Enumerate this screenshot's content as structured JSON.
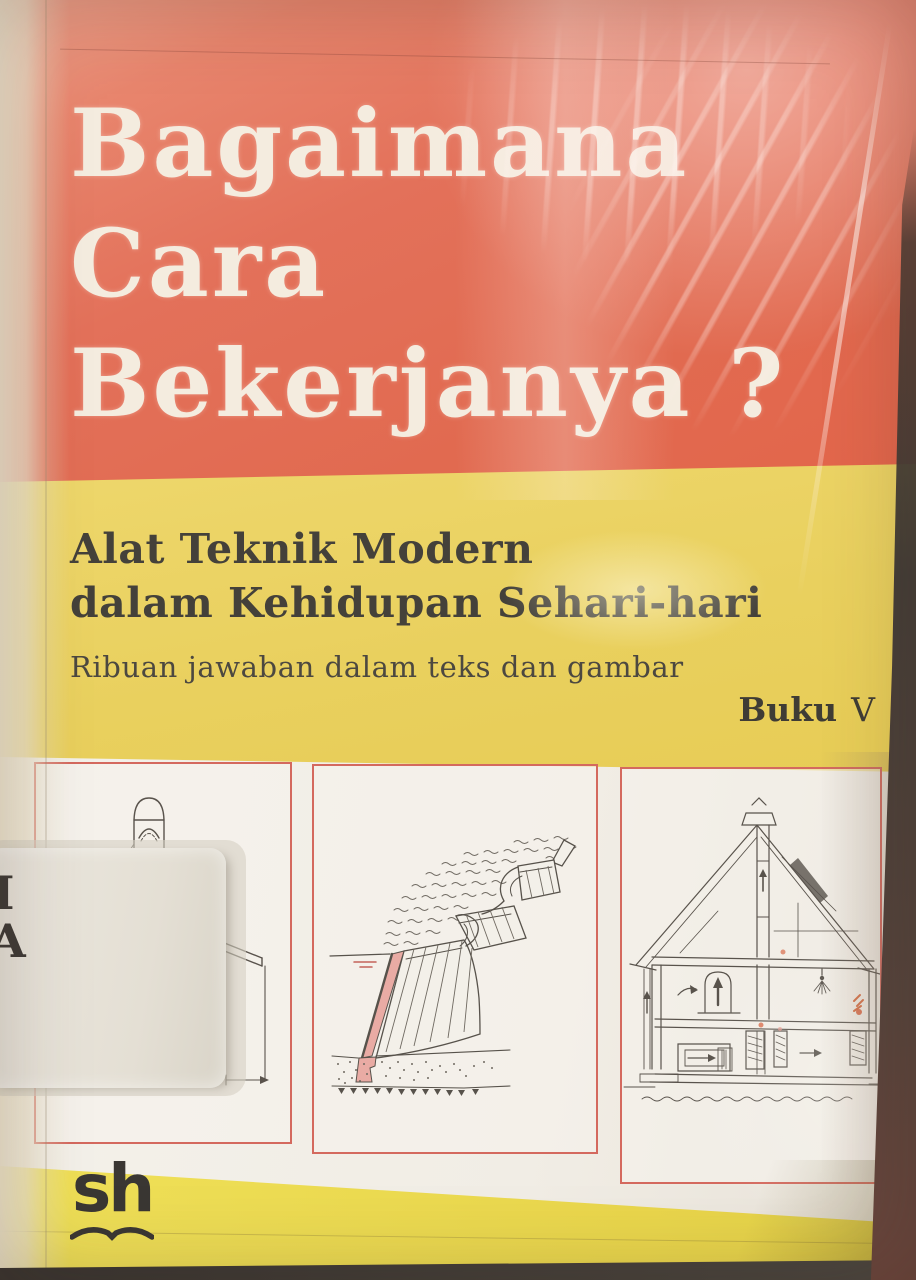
{
  "cover": {
    "title_lines": [
      "Bagaimana",
      "Cara",
      "Bekerjanya ?"
    ],
    "subtitle_lines": [
      "Alat Teknik Modern",
      "dalam Kehidupan Sehari-hari"
    ],
    "tagline": "Ribuan jawaban dalam teks dan gambar",
    "edition": {
      "word": "Buku",
      "numeral": "V"
    },
    "publisher_logo_text": "sh"
  },
  "spine_label": {
    "line1": "I",
    "line2": "A"
  },
  "illustrations": [
    {
      "name": "machine-sketch"
    },
    {
      "name": "stepped-dam-sketch"
    },
    {
      "name": "house-heating-sketch"
    }
  ],
  "colors": {
    "top_band": "#e2684f",
    "middle_band": "#e9d160",
    "illustration_band": "#f2eee7",
    "bottom_band": "#ecdb52",
    "title_text": "#f4ecdf",
    "ink": "#42403a",
    "panel_border": "#d4695e",
    "dam_pink": "#e9aba4",
    "accent_red": "#d4552f",
    "photo_background": "#4e4842"
  }
}
